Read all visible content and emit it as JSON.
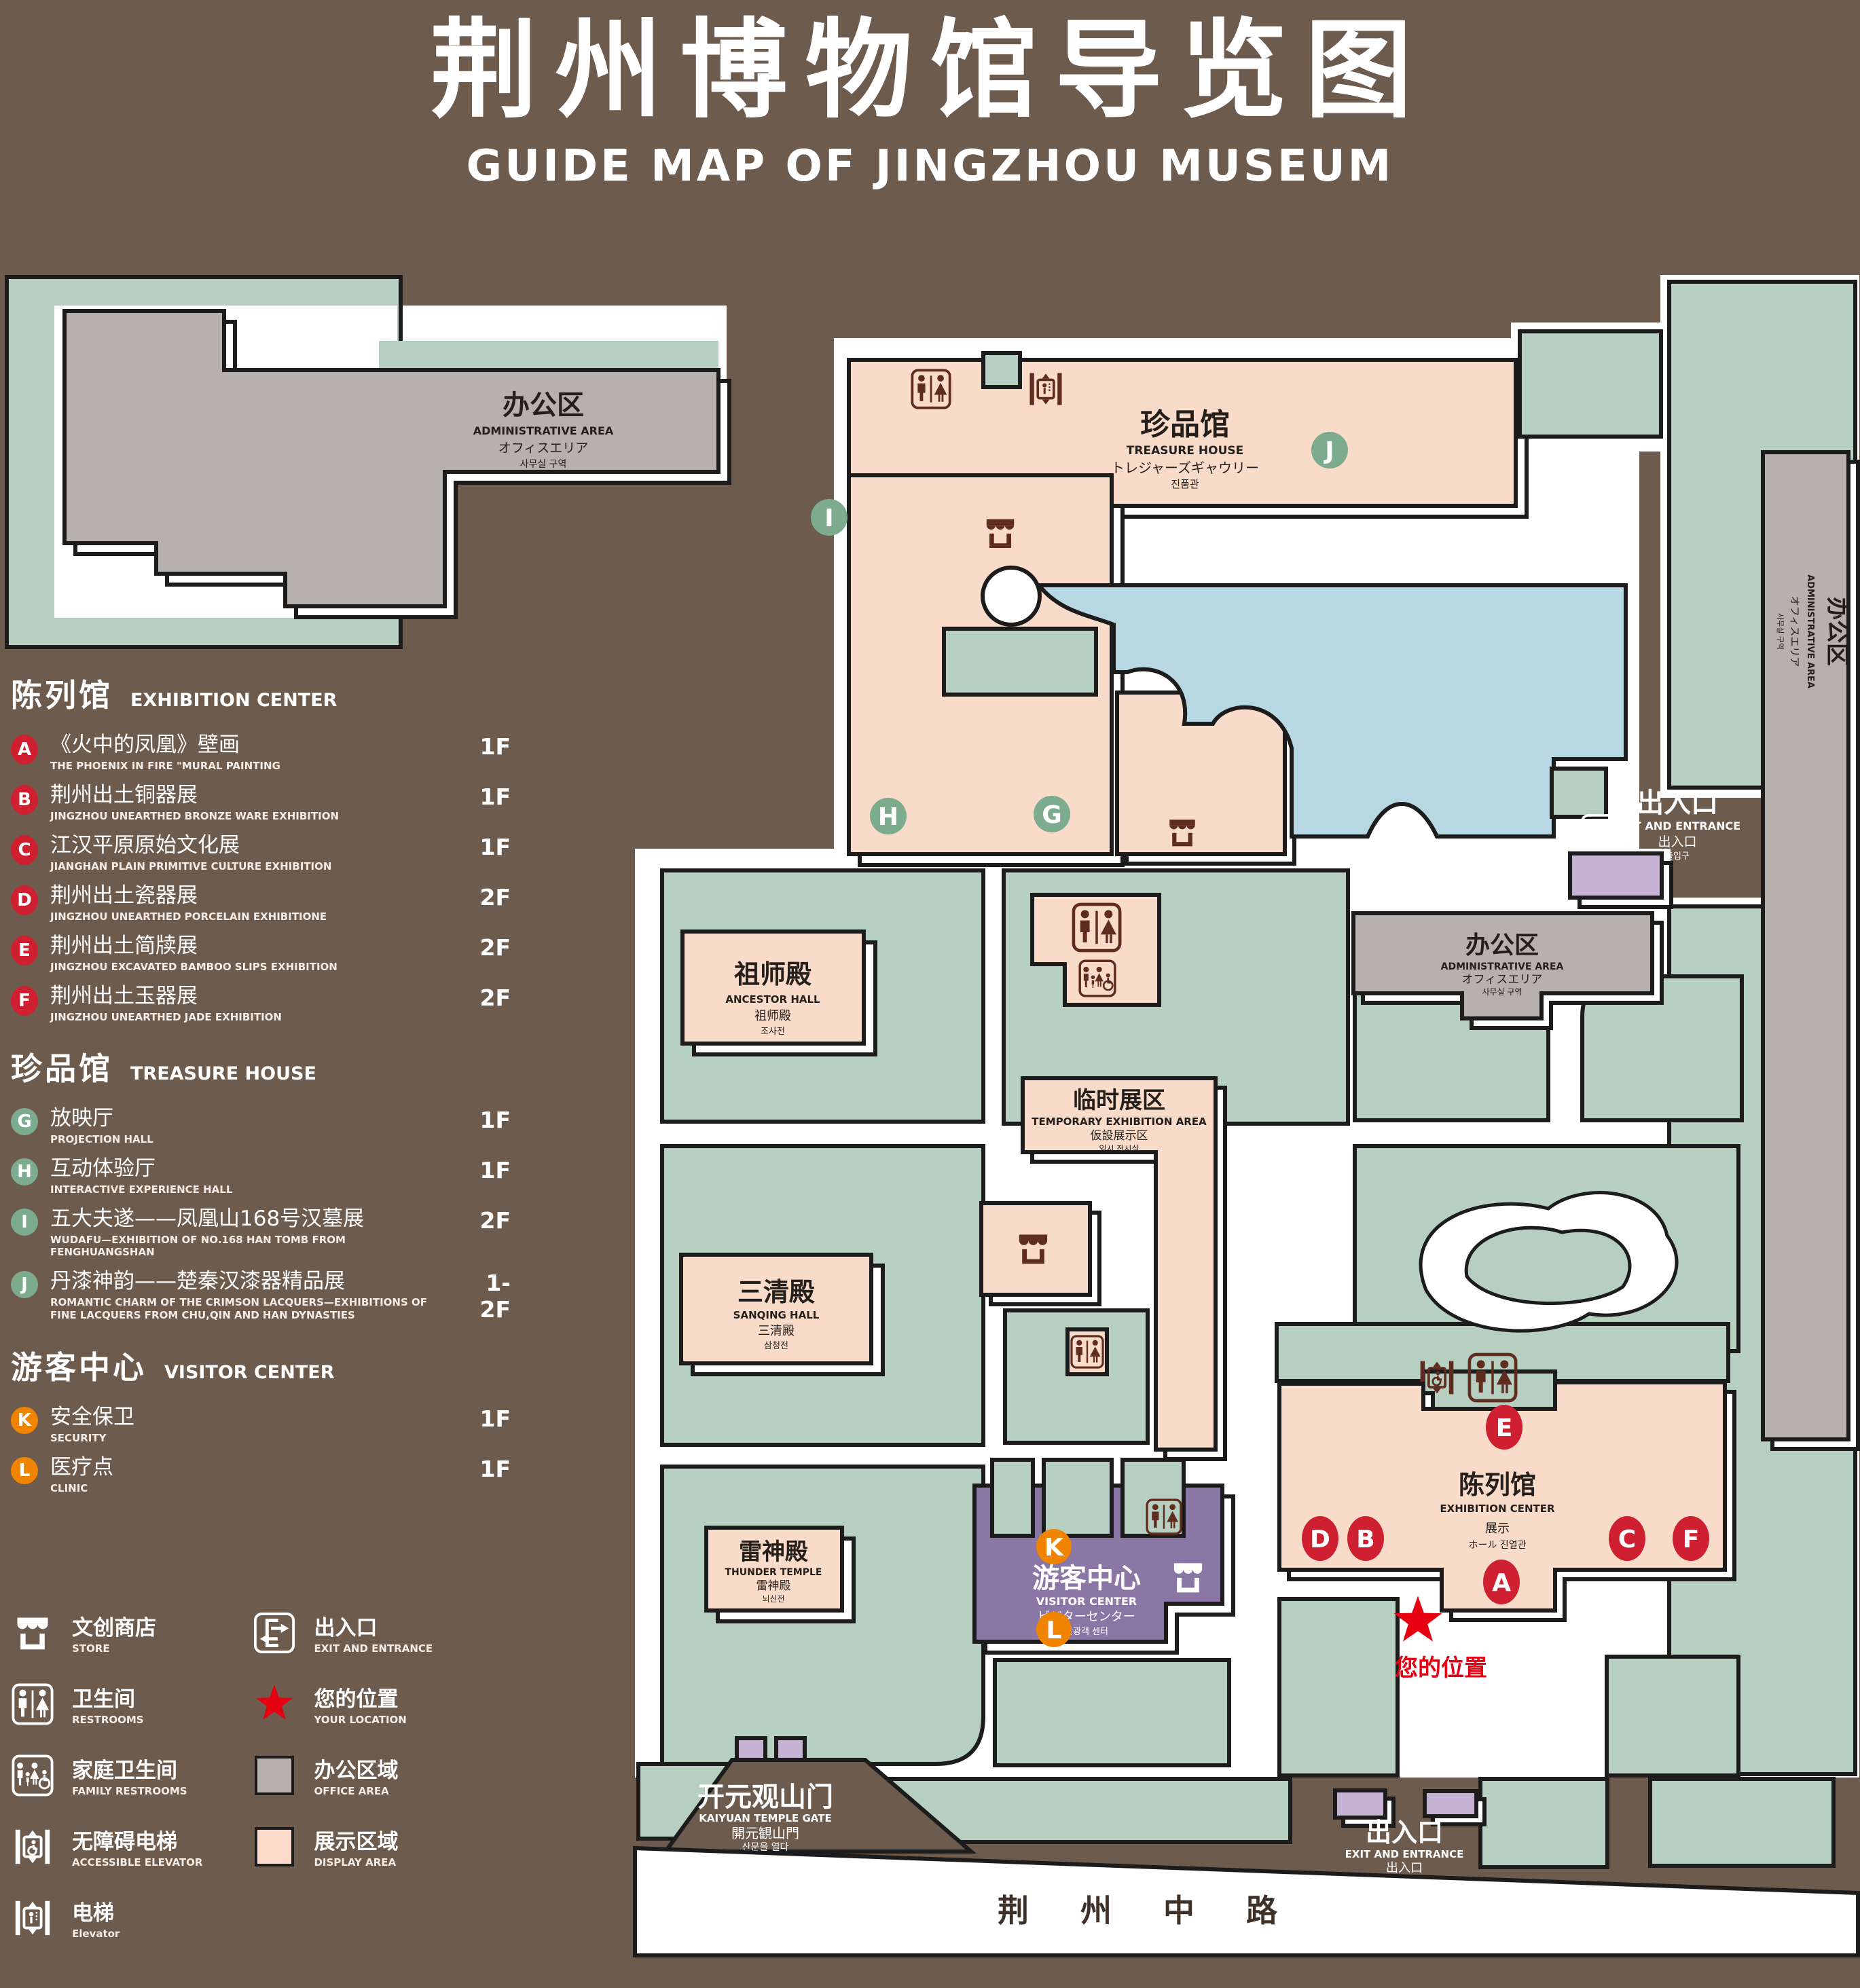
{
  "title": {
    "cn": "荆州博物馆导览图",
    "en": "GUIDE MAP OF JINGZHOU MUSEUM"
  },
  "colors": {
    "background": "#6d5b4e",
    "lawn": "#b6cfc1",
    "display_area": "#f9dbc9",
    "office_area": "#b6b1ad",
    "pond": "#b7d7e2",
    "visitor_center": "#8b77a5",
    "small_building": "#c6b2d3",
    "badge_red": "#ce2030",
    "badge_green": "#7dab8e",
    "badge_orange": "#f08300",
    "star_red": "#e60012",
    "icon_dark": "#5f2c20",
    "outline": "#1c1c1c"
  },
  "legend": {
    "sections": [
      {
        "title_cn": "陈列馆",
        "title_en": "EXHIBITION CENTER",
        "items": [
          {
            "letter": "A",
            "cn": "《火中的凤凰》壁画",
            "en": "THE PHOENIX IN FIRE \"MURAL PAINTING",
            "floor": "1F"
          },
          {
            "letter": "B",
            "cn": "荆州出土铜器展",
            "en": "JINGZHOU UNEARTHED BRONZE WARE EXHIBITION",
            "floor": "1F"
          },
          {
            "letter": "C",
            "cn": "江汉平原原始文化展",
            "en": "JIANGHAN PLAIN PRIMITIVE CULTURE EXHIBITION",
            "floor": "1F"
          },
          {
            "letter": "D",
            "cn": "荆州出土瓷器展",
            "en": "JINGZHOU UNEARTHED PORCELAIN EXHIBITIONE",
            "floor": "2F"
          },
          {
            "letter": "E",
            "cn": "荆州出土简牍展",
            "en": "JINGZHOU EXCAVATED BAMBOO SLIPS EXHIBITION",
            "floor": "2F"
          },
          {
            "letter": "F",
            "cn": "荆州出土玉器展",
            "en": "JINGZHOU UNEARTHED JADE EXHIBITION",
            "floor": "2F"
          }
        ]
      },
      {
        "title_cn": "珍品馆",
        "title_en": "TREASURE HOUSE",
        "items": [
          {
            "letter": "G",
            "cn": "放映厅",
            "en": "PROJECTION HALL",
            "floor": "1F"
          },
          {
            "letter": "H",
            "cn": "互动体验厅",
            "en": "INTERACTIVE EXPERIENCE HALL",
            "floor": "1F"
          },
          {
            "letter": "I",
            "cn": "五大夫遂——凤凰山168号汉墓展",
            "en": "WUDAFU—EXHIBITION OF NO.168 HAN TOMB FROM FENGHUANGSHAN",
            "floor": "2F"
          },
          {
            "letter": "J",
            "cn": "丹漆神韵——楚秦汉漆器精品展",
            "en": "ROMANTIC CHARM OF THE CRIMSON LACQUERS—EXHIBITIONS OF FINE LACQUERS FROM CHU,QIN AND HAN DYNASTIES",
            "floor": "1-2F"
          }
        ]
      },
      {
        "title_cn": "游客中心",
        "title_en": "VISITOR CENTER",
        "items": [
          {
            "letter": "K",
            "cn": "安全保卫",
            "en": "SECURITY",
            "floor": "1F"
          },
          {
            "letter": "L",
            "cn": "医疗点",
            "en": "CLINIC",
            "floor": "1F"
          }
        ]
      }
    ],
    "symbols_left": [
      {
        "icon": "store-icon",
        "cn": "文创商店",
        "en": "STORE"
      },
      {
        "icon": "restrooms-icon",
        "cn": "卫生间",
        "en": "RESTROOMS"
      },
      {
        "icon": "family-restrooms-icon",
        "cn": "家庭卫生间",
        "en": "FAMILY RESTROOMS"
      },
      {
        "icon": "accessible-elevator-icon",
        "cn": "无障碍电梯",
        "en": "ACCESSIBLE ELEVATOR"
      },
      {
        "icon": "elevator-icon",
        "cn": "电梯",
        "en": "Elevator"
      }
    ],
    "symbols_right": [
      {
        "icon": "exit-icon",
        "cn": "出入口",
        "en": "EXIT AND ENTRANCE"
      },
      {
        "icon": "location-star",
        "cn": "您的位置",
        "en": "YOUR LOCATION"
      },
      {
        "icon": "office-swatch",
        "cn": "办公区域",
        "en": "OFFICE AREA"
      },
      {
        "icon": "display-swatch",
        "cn": "展示区域",
        "en": "DISPLAY AREA"
      }
    ]
  },
  "map": {
    "admin": {
      "cn": "办公区",
      "en": "ADMINISTRATIVE AREA",
      "jp": "オフィスエリア",
      "kr": "사무실 구역"
    },
    "treasure": {
      "cn": "珍品馆",
      "en": "TREASURE HOUSE",
      "jp": "トレジャーズギャウリー",
      "kr": "진품관"
    },
    "ancestor": {
      "cn": "祖师殿",
      "en": "ANCESTOR HALL",
      "jp": "祖师殿",
      "kr": "조사전"
    },
    "temporary": {
      "cn": "临时展区",
      "en": "TEMPORARY EXHIBITION AREA",
      "jp": "仮設展示区",
      "kr": "임시 전시실"
    },
    "sanqing": {
      "cn": "三清殿",
      "en": "SANQING HALL",
      "jp": "三清殿",
      "kr": "삼청전"
    },
    "thunder": {
      "cn": "雷神殿",
      "en": "THUNDER TEMPLE",
      "jp": "雷神殿",
      "kr": "뇌신전"
    },
    "visitor": {
      "cn": "游客中心",
      "en": "VISITOR CENTER",
      "jp": "ビジターセンター",
      "kr": "관광객 센터"
    },
    "exhibition": {
      "cn": "陈列馆",
      "en": "EXHIBITION CENTER",
      "jp": "展示",
      "kr": "ホール 진열관"
    },
    "gate": {
      "cn": "开元观山门",
      "en": "KAIYUAN TEMPLE GATE",
      "jp": "開元観山門",
      "kr": "산문을 열다"
    },
    "exit": {
      "cn": "出入口",
      "en": "EXIT AND ENTRANCE",
      "jp": "出入口",
      "kr": "출입구"
    },
    "road": "荆 州 中 路",
    "your_location": "您的位置",
    "badge_letters": [
      "A",
      "B",
      "C",
      "D",
      "E",
      "F",
      "G",
      "H",
      "I",
      "J",
      "K",
      "L"
    ]
  }
}
